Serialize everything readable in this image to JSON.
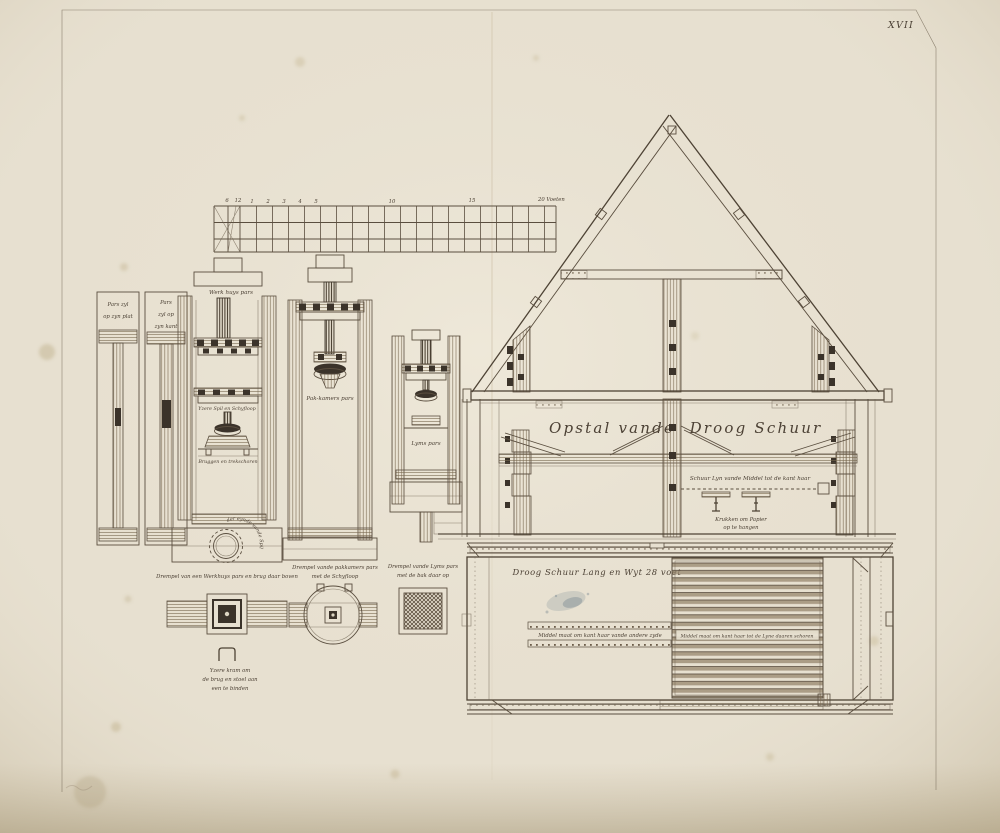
{
  "plate": {
    "number": "XVII"
  },
  "scale_bar": {
    "ticks": [
      "6",
      "12",
      "1",
      "2",
      "3",
      "4",
      "5",
      "10",
      "15"
    ],
    "end_label": "20 Voeten"
  },
  "press_sections": {
    "pars_plat": {
      "line1": "Pars zyl",
      "line2": "op zyn plat"
    },
    "pars_kant": {
      "line1": "Pars",
      "line2": "zyl op",
      "line3": "zyn kant"
    },
    "werkhuys": {
      "title": "Werk huys pars",
      "spil": "Yzere Spil en Schyfloop",
      "bruggen": "Bruggen en trekschoren"
    },
    "pakkamers": {
      "title": "Pak-kamers pars"
    },
    "lyms": {
      "title": "Lyms pars"
    },
    "ring": {
      "label": "Yzere kraag tot het onder eynde vande Spil"
    }
  },
  "thresholds": {
    "werkhuys": {
      "label": "Drempel van een Werkhuys pars en brug daar boven"
    },
    "kram": {
      "line1": "Yzere kram om",
      "line2": "de brug en stoel aan",
      "line3": "een te binden"
    },
    "pakkamers": {
      "line1": "Drempel vande pakkamers pars",
      "line2": "met de Schyfloop"
    },
    "lyms": {
      "line1": "Drempel vande Lyms pars",
      "line2": "met de bak daar op"
    }
  },
  "elevation": {
    "title_left": "Opstal vande",
    "title_right": "Droog Schuur",
    "schuur_lyn": "Schuur Lyn vande Middel tot de kant haar",
    "krukken_line1": "Krukken om Papier",
    "krukken_line2": "op te hangen"
  },
  "plan": {
    "title": "Droog Schuur Lang en Wyt 28 voet",
    "middel_left": "Middel maat om kant haar vande andere zyde",
    "middel_right": "Middel maat om kant haar tot de Lyne daaren schoren"
  }
}
